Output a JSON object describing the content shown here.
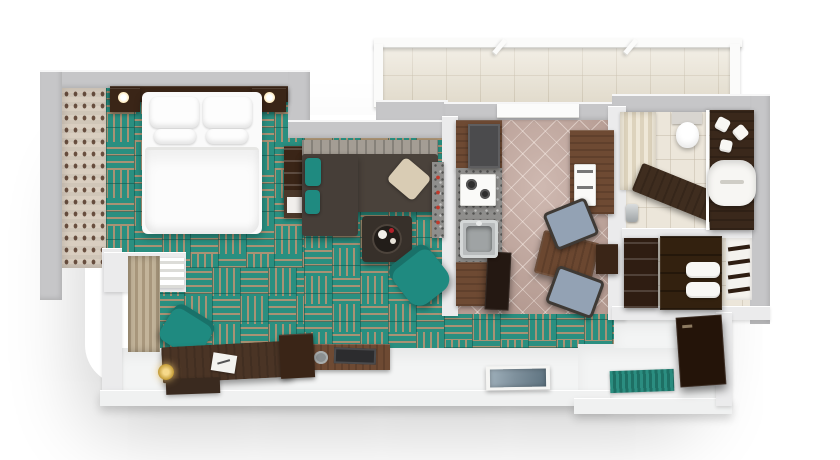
{
  "scene": {
    "title": "Top-down 3D render of a one-bedroom apartment floor plan",
    "view": "top-down 3D architectural render",
    "background": "#ffffff"
  },
  "palette": {
    "carpet_teal": "#2a8f80",
    "carpet_stripe_tan": "#b09273",
    "outer_wall_gray": "#c6c6c8",
    "inner_wall_white": "#ebebec",
    "wallpaper_beige": "#d9cec0",
    "wood_dark": "#3a2517",
    "wood_medium": "#6e4a33",
    "sofa_charcoal": "#4a423b",
    "accent_teal": "#1f8a80",
    "kitchen_tile_mauve": "#b59b92",
    "granite_gray": "#8f8e8c",
    "bathroom_cream": "#ece6da",
    "balcony_beige": "#e9e2d2",
    "bedding_white": "#fafafa",
    "chair_blue_gray": "#93a2b4",
    "flower_red": "#b3202a",
    "brass_gold": "#c8a13e",
    "artwork_blue_gray": "#8fa3b0"
  },
  "rooms": [
    {
      "id": "bedroom",
      "label": "Bedroom",
      "flooring": "teal basket-weave carpet tiles"
    },
    {
      "id": "living-room",
      "label": "Living room",
      "flooring": "teal basket-weave carpet tiles"
    },
    {
      "id": "work-nook",
      "label": "Desk nook",
      "flooring": "teal carpet with white stone border"
    },
    {
      "id": "kitchen-dining",
      "label": "Kitchen and dining area",
      "flooring": "mauve diagonal ceramic tile"
    },
    {
      "id": "bathroom",
      "label": "Bathroom",
      "flooring": "cream ceramic tile"
    },
    {
      "id": "closet",
      "label": "Wardrobe / linen closet",
      "flooring": "light tile"
    },
    {
      "id": "hallway",
      "label": "Hallway",
      "flooring": "teal carpet and white stone"
    },
    {
      "id": "entry",
      "label": "Entry hall",
      "flooring": "white stone with teal doormat"
    },
    {
      "id": "balcony",
      "label": "Balcony terrace",
      "flooring": "beige tile with glass railing"
    }
  ],
  "furniture": {
    "bedroom": [
      "Double bed with white duvet",
      "White pillows",
      "Dark wood headboard wall",
      "Nightstand with lamp (left)",
      "Nightstand with lamp (right)",
      "Patterned wallpaper accent wall",
      "Window wall with white shutter"
    ],
    "living": [
      "L-shaped charcoal sectional sofa",
      "Striped back cushions",
      "Teal accent pillows",
      "Beige accent pillow",
      "Square coffee table with serving tray",
      "Teal swivel armchair",
      "Bookshelf",
      "Side cabinet",
      "TV console with flowers and television"
    ],
    "nook": [
      "Dark wood writing desk",
      "Teal desk chair",
      "Notepad on desk",
      "Brass floor lamp",
      "Dark floor mat",
      "Window with brown drapes"
    ],
    "kitchen": [
      "Granite worktop",
      "White cooktop with burners",
      "Stainless steel sink",
      "Dark refrigerator column",
      "Upper wood cabinets",
      "Built-in oven and microwave column",
      "Dark wood dining table",
      "Dining chair with blue-gray seat (top)",
      "Dining chair with blue-gray seat (bottom)",
      "Side serving cabinet",
      "Tall dark cabinet at kitchen entrance",
      "Bar ledge with red knobs"
    ],
    "bathroom": [
      "White toilet",
      "Cream shower curtain",
      "Bathtub with dark wood deck",
      "Chrome tub faucet",
      "Dark wood vanity counter",
      "White vessel sink",
      "Folded white towels",
      "Mirror glass partition"
    ],
    "closet": [
      "Open shelving unit",
      "Dark wardrobe cabinet with drawers",
      "Stacked white towels",
      "Towel ladder rack"
    ],
    "entry": [
      "Teal striped doormat",
      "Dark entry wardrobe panel",
      "Framed picture lying on floor"
    ],
    "balcony": [
      "Glass railing",
      "Glass panel dividers",
      "Beige tile deck"
    ]
  }
}
